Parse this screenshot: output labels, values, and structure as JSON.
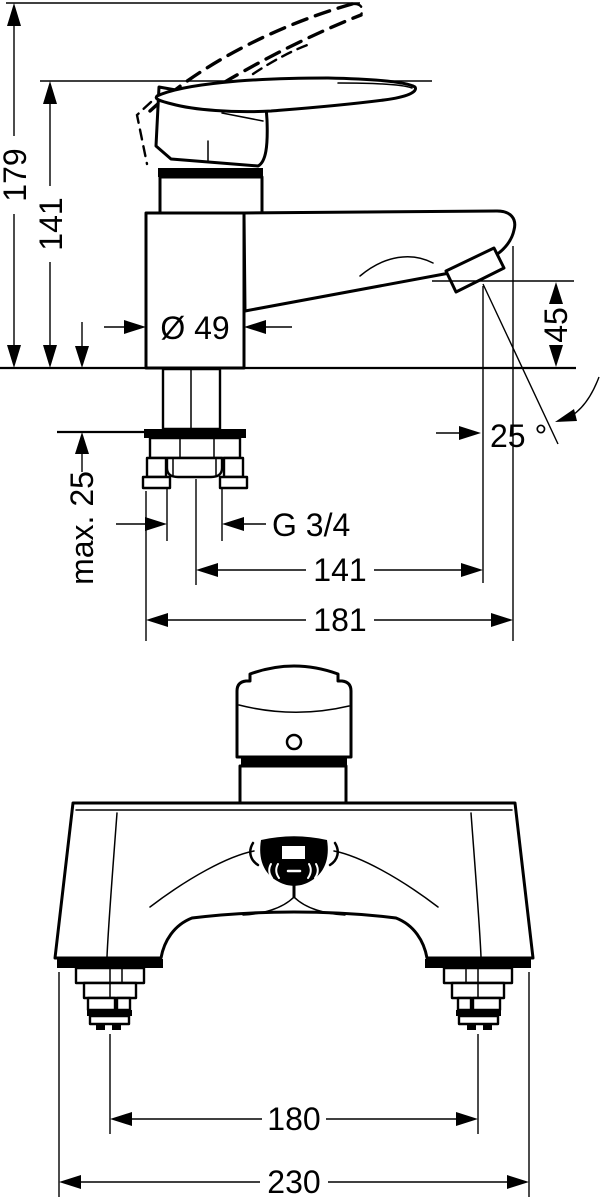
{
  "drawing": {
    "colors": {
      "line": "#000000",
      "background": "#ffffff"
    },
    "side_view": {
      "total_height": "179",
      "height_to_spout": "141",
      "body_diameter": "Ø 49",
      "outlet_height": "45",
      "stream_angle": "25 °",
      "max_deck_thickness": "max. 25",
      "thread_size": "G 3/4",
      "spout_reach": "141",
      "total_depth": "181"
    },
    "front_view": {
      "shank_distance": "180",
      "overall_width": "230"
    }
  }
}
